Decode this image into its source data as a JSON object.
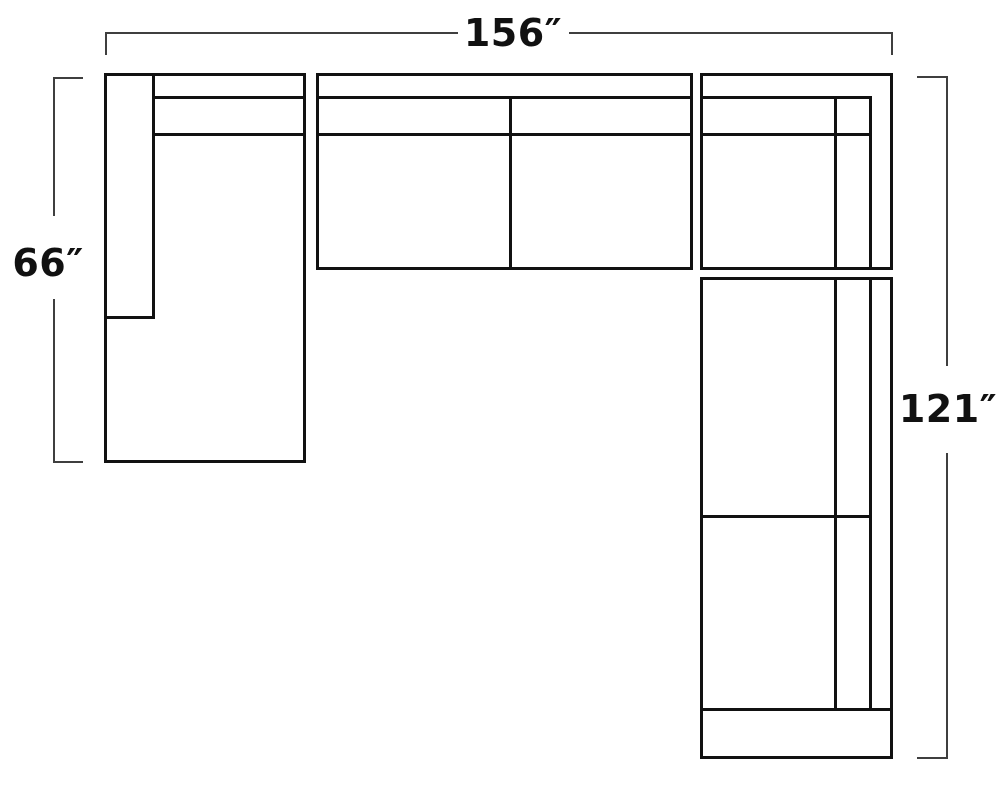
{
  "diagram": {
    "dimensions": {
      "width_label": "156″",
      "left_height_label": "66″",
      "right_height_label": "121″"
    },
    "colors": {
      "background": "#ffffff",
      "outline": "#111111",
      "dimension_line": "#3f3f3f",
      "label_text": "#111111"
    }
  }
}
